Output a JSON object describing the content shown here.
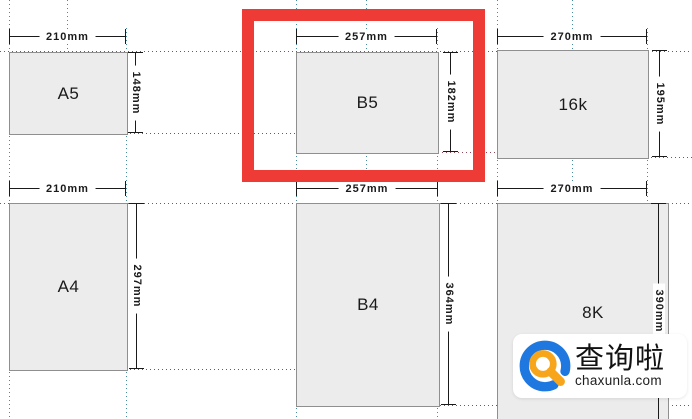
{
  "papers": [
    {
      "id": "a5",
      "label": "A5",
      "width_mm": "210mm",
      "height_mm": "148mm"
    },
    {
      "id": "b5",
      "label": "B5",
      "width_mm": "257mm",
      "height_mm": "182mm"
    },
    {
      "id": "16k",
      "label": "16k",
      "width_mm": "270mm",
      "height_mm": "195mm"
    },
    {
      "id": "a4",
      "label": "A4",
      "width_mm": "210mm",
      "height_mm": "297mm"
    },
    {
      "id": "b4",
      "label": "B4",
      "width_mm": "257mm",
      "height_mm": "364mm"
    },
    {
      "id": "8k",
      "label": "8K",
      "width_mm": "270mm",
      "height_mm": "390mm"
    }
  ],
  "highlight": {
    "target": "B5",
    "color": "#ee3b36"
  },
  "watermark": {
    "brand": "查询啦",
    "domain": "chaxunla.com",
    "ring_color": "#1e78e0",
    "magnifier_color": "#f7a61b"
  },
  "colors": {
    "box_fill": "#ececec",
    "box_border": "#8f8f8f",
    "guide_vertical": "#4a8a9e",
    "guide_horizontal": "#8f4a55",
    "dimension": "#1a1a1a"
  }
}
